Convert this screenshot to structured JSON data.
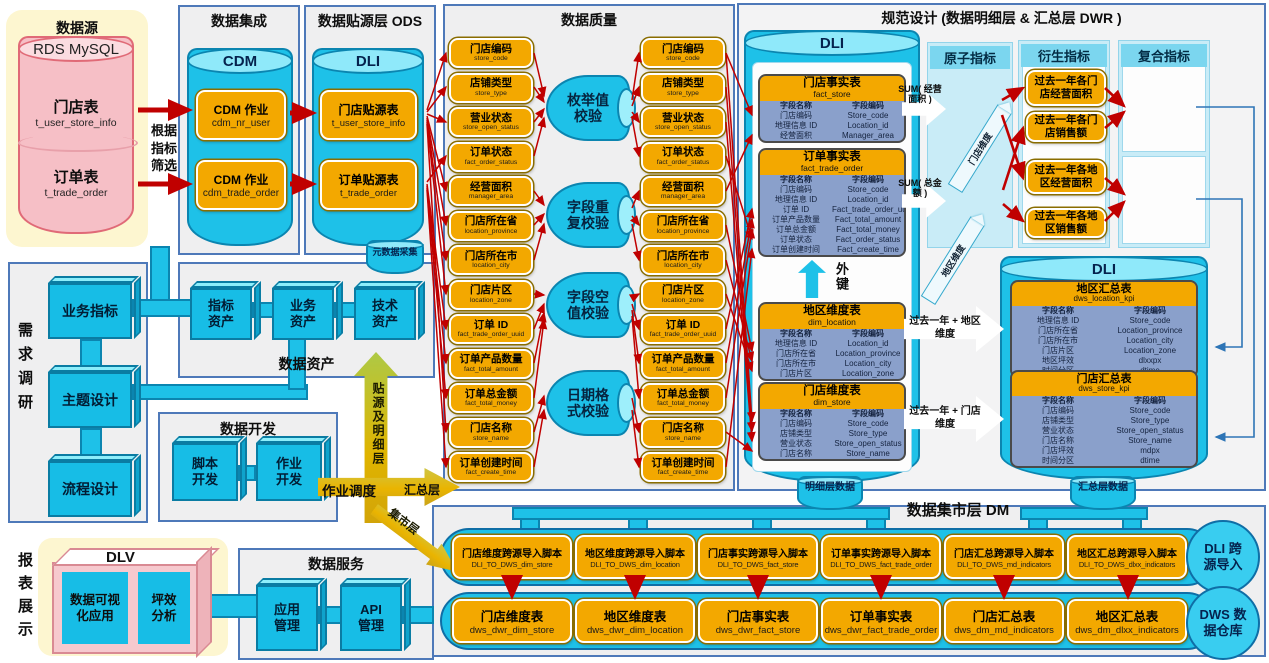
{
  "src": {
    "title": "数据源",
    "db": "RDS MySQL",
    "t1_cn": "门店表",
    "t1_code": "t_user_store_info",
    "t2_cn": "订单表",
    "t2_code": "t_trade_order",
    "filter": "根据指标筛选"
  },
  "integration": {
    "title": "数据集成",
    "cyl": "CDM",
    "jobs": [
      {
        "cn": "CDM 作业",
        "code": "cdm_nr_user"
      },
      {
        "cn": "CDM 作业",
        "code": "cdm_trade_order"
      }
    ]
  },
  "ods": {
    "title": "数据贴源层  ODS",
    "cyl": "DLI",
    "tables": [
      {
        "cn": "门店贴源表",
        "code": "t_user_store_info"
      },
      {
        "cn": "订单贴源表",
        "code": "t_trade_order"
      }
    ],
    "meta": "元数据采集"
  },
  "quality": {
    "title": "数据质量",
    "checks": [
      "枚举值校验",
      "字段重复校验",
      "字段空值校验",
      "日期格式校验"
    ],
    "fields": [
      {
        "cn": "门店编码",
        "code": "store_code"
      },
      {
        "cn": "店铺类型",
        "code": "store_type"
      },
      {
        "cn": "营业状态",
        "code": "store_open_status"
      },
      {
        "cn": "订单状态",
        "code": "fact_order_status"
      },
      {
        "cn": "经营面积",
        "code": "manager_area"
      },
      {
        "cn": "门店所在省",
        "code": "location_province"
      },
      {
        "cn": "门店所在市",
        "code": "location_city"
      },
      {
        "cn": "门店片区",
        "code": "location_zone"
      },
      {
        "cn": "订单 ID",
        "code": "fact_trade_order_uuid"
      },
      {
        "cn": "订单产品数量",
        "code": "fact_total_amount"
      },
      {
        "cn": "订单总金额",
        "code": "fact_total_money"
      },
      {
        "cn": "门店名称",
        "code": "store_name"
      },
      {
        "cn": "订单创建时间",
        "code": "fact_create_time"
      }
    ]
  },
  "design": {
    "title": "规范设计 (数据明细层 & 汇总层  DWR )",
    "dli": "DLI",
    "field_header": [
      "字段名称",
      "字段编码"
    ],
    "fact_store": {
      "cn": "门店事实表",
      "code": "fact_store",
      "rows": [
        [
          "门店编码",
          "Store_code"
        ],
        [
          "地理信息 ID",
          "Location_id"
        ],
        [
          "经营面积",
          "Manager_area"
        ]
      ]
    },
    "fact_trade_order": {
      "cn": "订单事实表",
      "code": "fact_trade_order",
      "rows": [
        [
          "门店编码",
          "Store_code"
        ],
        [
          "地理信息 ID",
          "Location_id"
        ],
        [
          "订单 ID",
          "Fact_trade_order_uuid"
        ],
        [
          "订单产品数量",
          "Fact_total_amount"
        ],
        [
          "订单总金额",
          "Fact_total_money"
        ],
        [
          "订单状态",
          "Fact_order_status"
        ],
        [
          "订单创建时间",
          "Fact_create_time"
        ]
      ]
    },
    "dim_location": {
      "cn": "地区维度表",
      "code": "dim_location",
      "rows": [
        [
          "地理信息 ID",
          "Location_id"
        ],
        [
          "门店所在省",
          "Location_province"
        ],
        [
          "门店所在市",
          "Location_city"
        ],
        [
          "门店片区",
          "Location_zone"
        ]
      ]
    },
    "dim_store": {
      "cn": "门店维度表",
      "code": "dim_store",
      "rows": [
        [
          "门店编码",
          "Store_code"
        ],
        [
          "店铺类型",
          "Store_type"
        ],
        [
          "营业状态",
          "Store_open_status"
        ],
        [
          "门店名称",
          "Store_name"
        ]
      ]
    },
    "dws_location_kpi": {
      "cn": "地区汇总表",
      "code": "dws_location_kpi",
      "rows": [
        [
          "地理信息 ID",
          "Store_code"
        ],
        [
          "门店所在省",
          "Location_province"
        ],
        [
          "门店所在市",
          "Location_city"
        ],
        [
          "门店片区",
          "Location_zone"
        ],
        [
          "地区坪效",
          "dlxxpx"
        ],
        [
          "时间分区",
          "dtime"
        ]
      ]
    },
    "dws_store_kpi": {
      "cn": "门店汇总表",
      "code": "dws_store_kpi",
      "rows": [
        [
          "门店编码",
          "Store_code"
        ],
        [
          "店铺类型",
          "Store_type"
        ],
        [
          "营业状态",
          "Store_open_status"
        ],
        [
          "门店名称",
          "Store_name"
        ],
        [
          "门店坪效",
          "mdpx"
        ],
        [
          "时间分区",
          "dtime"
        ]
      ]
    },
    "fk": "外键",
    "sum1": "SUM( 经营面积 )",
    "sum2": "SUM( 总金额 )",
    "atomic": {
      "title": "原子指标",
      "i1_cn": "门店面积",
      "i1_code": "MDMJ",
      "i2_cn": "销售额",
      "i2_code": "XSE"
    },
    "derived": {
      "title": "衍生指标",
      "items": [
        {
          "cn": "过去一年各门店经营面积"
        },
        {
          "cn": "过去一年各门店销售额"
        },
        {
          "cn": "过去一年各地区经营面积"
        },
        {
          "cn": "过去一年各地区销售额"
        }
      ]
    },
    "composite": {
      "title": "复合指标",
      "i1_cn": "门店坪效",
      "i1_code": "mdpx",
      "i2_cn": "地区坪效",
      "i2_code": "dlxxpx"
    },
    "agg1": "过去一年 + 地区维度",
    "agg2": "过去一年 + 门店维度",
    "dim1": "门店维度",
    "dim2": "地区维度",
    "detail": "明细层数据",
    "summary": "汇总层数据"
  },
  "survey": {
    "title": "需求调研",
    "items": [
      {
        "cn": "业务指标"
      },
      {
        "cn": "主题设计"
      },
      {
        "cn": "流程设计"
      }
    ]
  },
  "assets": {
    "title": "数据资产",
    "items": [
      {
        "cn": "指标资产"
      },
      {
        "cn": "业务资产"
      },
      {
        "cn": "技术资产"
      }
    ]
  },
  "dev": {
    "title": "数据开发",
    "items": [
      {
        "cn": "脚本开发"
      },
      {
        "cn": "作业开发"
      }
    ]
  },
  "flows": {
    "up": "贴源及明细层",
    "schedule": "作业调度",
    "summary": "汇总层",
    "mart": "集市层"
  },
  "report": {
    "title": "报表展示",
    "dlv": "DLV",
    "app1": "数据可视化应用",
    "app2": "坪效分析"
  },
  "service": {
    "title": "数据服务",
    "items": [
      {
        "cn": "应用管理"
      },
      {
        "cn": "API管理"
      }
    ]
  },
  "dm": {
    "title": "数据集市层  DM",
    "scripts": [
      {
        "cn": "门店维度跨源导入脚本",
        "code": "DLI_TO_DWS_dim_store"
      },
      {
        "cn": "地区维度跨源导入脚本",
        "code": "DLI_TO_DWS_dim_location"
      },
      {
        "cn": "门店事实跨源导入脚本",
        "code": "DLI_TO_DWS_fact_store"
      },
      {
        "cn": "订单事实跨源导入脚本",
        "code": "DLI_TO_DWS_fact_trade_order"
      },
      {
        "cn": "门店汇总跨源导入脚本",
        "code": "DLI_TO_DWS_md_indicators"
      },
      {
        "cn": "地区汇总跨源导入脚本",
        "code": "DLI_TO_DWS_dlxx_indicators"
      }
    ],
    "tables": [
      {
        "cn": "门店维度表",
        "code": "dws_dwr_dim_store"
      },
      {
        "cn": "地区维度表",
        "code": "dws_dwr_dim_location"
      },
      {
        "cn": "门店事实表",
        "code": "dws_dwr_fact_store"
      },
      {
        "cn": "订单事实表",
        "code": "dws_dwr_fact_trade_order"
      },
      {
        "cn": "门店汇总表",
        "code": "dws_dm_md_indicators"
      },
      {
        "cn": "地区汇总表",
        "code": "dws_dm_dlxx_indicators"
      }
    ],
    "circle1": "DLI 跨源导入",
    "circle2": "DWS 数据仓库"
  }
}
